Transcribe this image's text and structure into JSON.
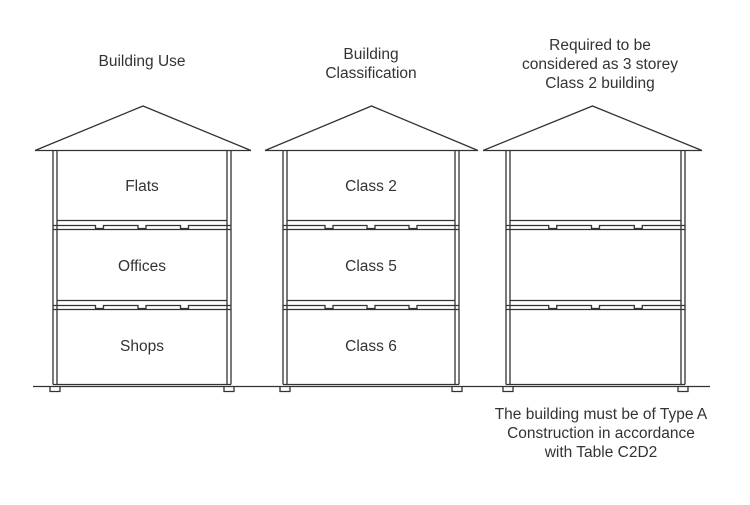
{
  "diagram": {
    "line_color": "#333333",
    "text_color": "#333333",
    "buildings": [
      {
        "name": "building-use",
        "title": "Building Use",
        "floors": [
          "Flats",
          "Offices",
          "Shops"
        ]
      },
      {
        "name": "building-classification",
        "title": "Building\nClassification",
        "floors": [
          "Class 2",
          "Class 5",
          "Class 6"
        ]
      },
      {
        "name": "required-class-2",
        "title": "Required to be\nconsidered as 3 storey\nClass 2 building",
        "floors": [
          "",
          "",
          ""
        ]
      }
    ],
    "footnote": "The building must be of Type A\nConstruction in accordance\nwith Table C2D2"
  }
}
